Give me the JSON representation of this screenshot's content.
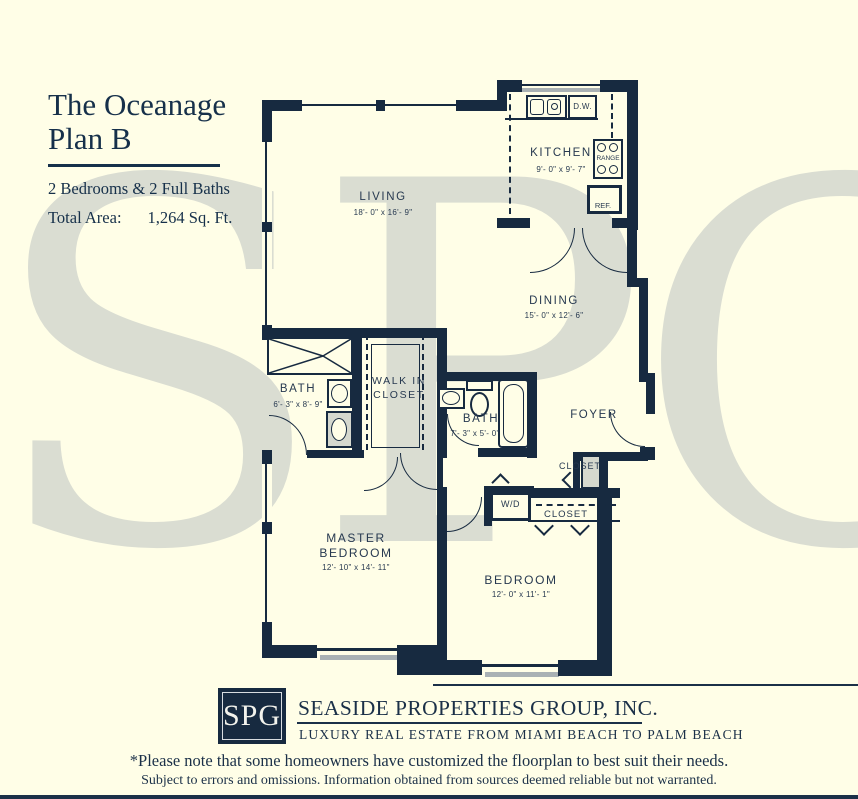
{
  "header": {
    "title_line1": "The Oceanage",
    "title_line2": "Plan B",
    "subtitle": "2 Bedrooms & 2 Full Baths",
    "area_label": "Total Area:",
    "area_value": "1,264 Sq. Ft."
  },
  "watermark": "SPG",
  "rooms": {
    "living": {
      "name": "LIVING",
      "dims": "18'- 0\" x 16'- 9\""
    },
    "kitchen": {
      "name": "KITCHEN",
      "dims": "9'- 0\" x 9'- 7\""
    },
    "dining": {
      "name": "DINING",
      "dims": "15'- 0\" x 12'- 6\""
    },
    "master_bath": {
      "name": "BATH",
      "dims": "6'- 3\" x 8'- 9\""
    },
    "walk_in_closet": {
      "name_line1": "WALK IN",
      "name_line2": "CLOSET"
    },
    "bath2": {
      "name": "BATH",
      "dims": "7'- 3\" x 5'- 0\""
    },
    "foyer": {
      "name": "FOYER"
    },
    "foyer_closet": {
      "name": "CLOSET"
    },
    "hall_closet": {
      "name": "CLOSET"
    },
    "master_bedroom": {
      "name_line1": "MASTER",
      "name_line2": "BEDROOM",
      "dims": "12'- 10\" x 14'- 11\""
    },
    "bedroom": {
      "name": "BEDROOM",
      "dims": "12'- 0\" x 11'- 1\""
    }
  },
  "fixtures": {
    "dishwasher": "D.W.",
    "range": "RANGE",
    "refrigerator": "REF.",
    "washer_dryer": "W/D"
  },
  "footer": {
    "logo_text": "SPG",
    "company": "SEASIDE PROPERTIES GROUP, INC.",
    "tagline": "LUXURY REAL ESTATE FROM MIAMI BEACH TO PALM BEACH",
    "note1": "*Please note that some homeowners have customized the floorplan to best suit their needs.",
    "note2": "Subject to errors and omissions. Information obtained from sources deemed reliable but not warranted."
  },
  "colors": {
    "background": "#FFFEE7",
    "wall_navy": "#172A40",
    "watermark_gray": "#DADDD2",
    "window_shadow_gray": "#A9B1B4"
  }
}
